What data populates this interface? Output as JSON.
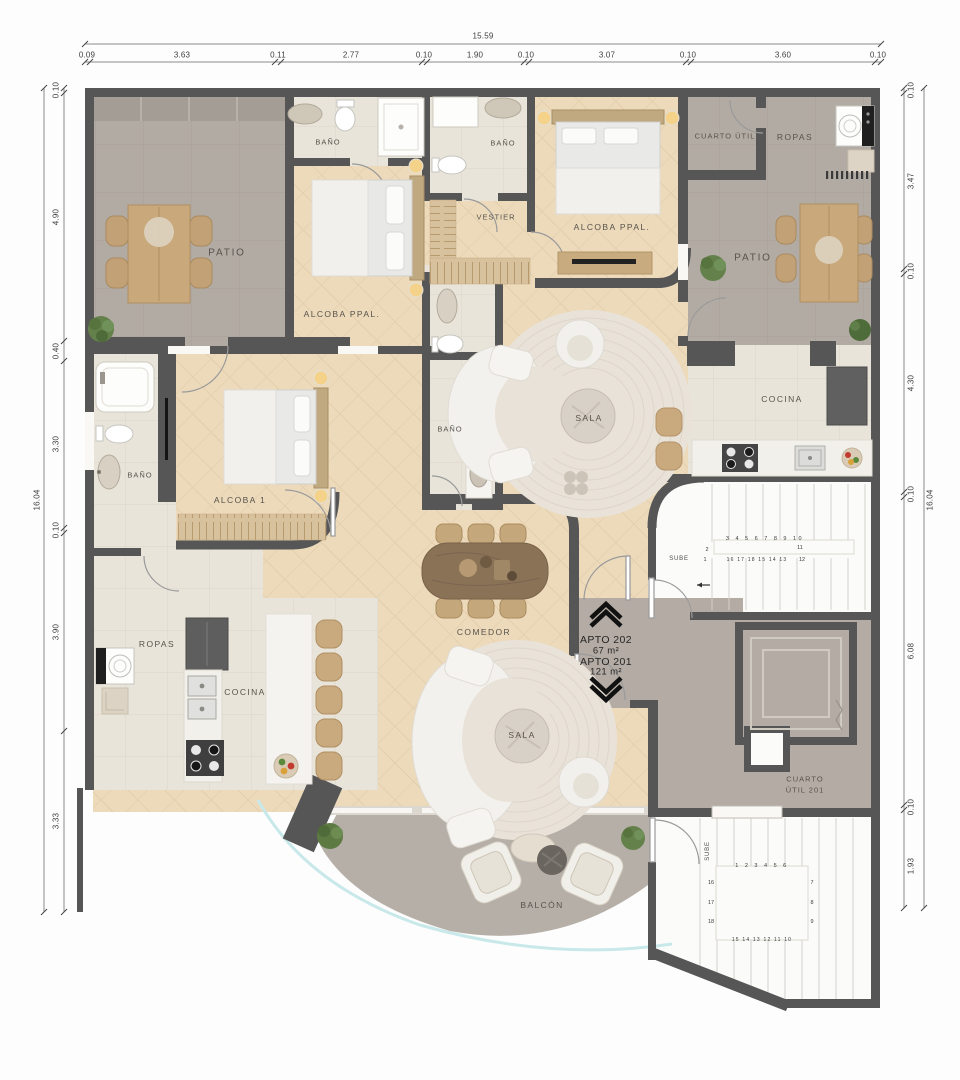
{
  "dimensions": {
    "top": {
      "total": "15.59",
      "segments": [
        "0.09",
        "3.63",
        "0.11",
        "2.77",
        "0.10",
        "1.90",
        "0.10",
        "3.07",
        "0.10",
        "3.60",
        "0.10"
      ]
    },
    "left": {
      "total": "16.04",
      "segments": [
        "0.10",
        "4.90",
        "0.40",
        "3.30",
        "0.10",
        "3.90",
        "3.33"
      ]
    },
    "right": {
      "total": "16.04",
      "segments": [
        "0.10",
        "3.47",
        "0.10",
        "4.30",
        "0.10",
        "6.08",
        "0.10",
        "1.93"
      ]
    }
  },
  "rooms": {
    "patio_top_left": "PATIO",
    "bano_top_left": "BAÑO",
    "alcoba_ppal_left": "ALCOBA PPAL.",
    "bano_top_center": "BAÑO",
    "vestier": "VESTIER",
    "alcoba_ppal_top": "ALCOBA PPAL.",
    "cuarto_util": "CUARTO ÚTIL",
    "ropas_top_right": "ROPAS",
    "patio_right": "PATIO",
    "cocina_right": "COCINA",
    "bano_mid_left": "BAÑO",
    "alcoba_1": "ALCOBA 1",
    "bano_center": "BAÑO",
    "sala_center": "SALA",
    "comedor": "COMEDOR",
    "ropas_bottom_left": "ROPAS",
    "cocina_bottom_left": "COCINA",
    "sala_bottom": "SALA",
    "balcon": "BALCÓN",
    "cuarto_util_201_line1": "CUARTO",
    "cuarto_util_201_line2": "ÚTIL 201"
  },
  "apartments": {
    "apto202_name": "APTO 202",
    "apto202_area": "67 m²",
    "apto201_name": "APTO 201",
    "apto201_area": "121 m²"
  },
  "stairs": {
    "stair1": {
      "label": "SUBE",
      "top_row": "3 4 5 6 7 8 9 10",
      "left_top": "2",
      "left_bottom": "1",
      "right_top": "11",
      "right_bottom": "12",
      "bottom_row": "16 17 18 15 14 13"
    },
    "stair2": {
      "label": "SUBE",
      "top_row": "1 2 3 4 5 6",
      "left_col": [
        "16",
        "17",
        "18"
      ],
      "right_col": [
        "7",
        "8",
        "9"
      ],
      "bottom_row": "15 14 13 12 11 10"
    }
  },
  "colors": {
    "wall": "#565656",
    "wood_floor": "#ecdabb",
    "patio_floor": "#b2aba3",
    "tile_floor": "#e9e4da",
    "balcony_floor": "#b6afa7",
    "glass": "#c8e8ea",
    "plant": "#65814b",
    "furniture_wood": "#c9a87b"
  }
}
